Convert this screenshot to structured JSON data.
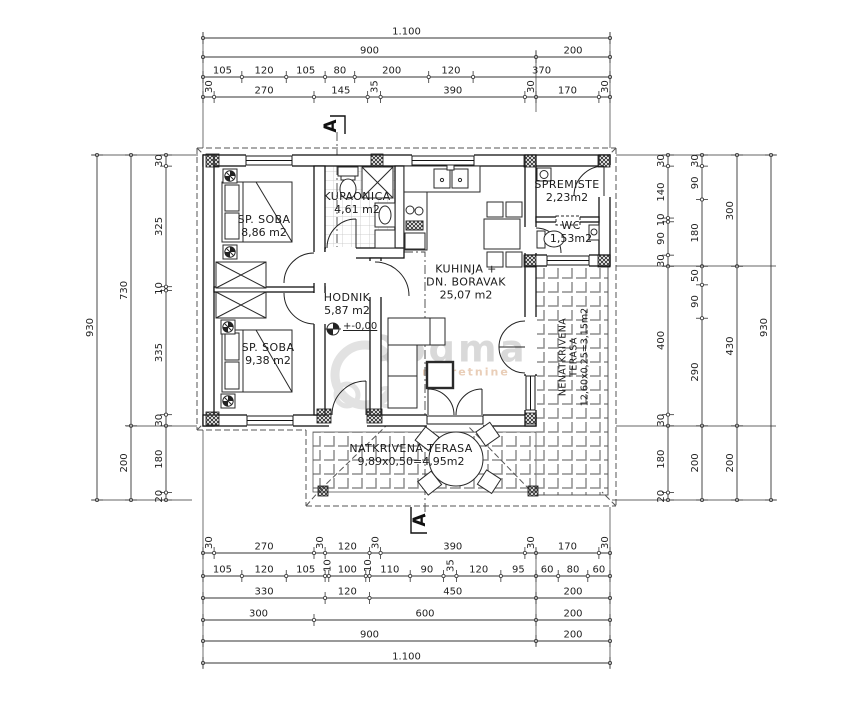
{
  "drawing": {
    "section_marker": "A",
    "elevation_label": "+-0,00",
    "watermark": {
      "text": "Dogma",
      "subtext": "nekretnine"
    }
  },
  "rooms": {
    "bedroom1": {
      "name": "SP. SOBA",
      "area": "8,86 m2"
    },
    "bathroom": {
      "name": "KUPAONICA",
      "area": "4,61 m2"
    },
    "storage": {
      "name": "SPREMISTE",
      "area": "2,23m2"
    },
    "wc": {
      "name": "WC",
      "area": "1,53m2"
    },
    "kitchen_living": {
      "name_line1": "KUHINJA +",
      "name_line2": "DN. BORAVAK",
      "area": "25,07 m2"
    },
    "hallway": {
      "name": "HODNIK",
      "area": "5,87 m2"
    },
    "bedroom2": {
      "name": "SP. SOBA",
      "area": "9,38 m2"
    },
    "covered_terrace": {
      "name": "NATKRIVENA TERASA",
      "area": "9,89x0,50=4,95m2"
    },
    "uncovered_terrace": {
      "name_line1": "NENATKRIVENA",
      "name_line2": "TERASA",
      "area": "12,60x0,25=3,15m2"
    }
  },
  "dimensions": {
    "top_rows": [
      [
        "1.100"
      ],
      [
        "900",
        "200"
      ],
      [
        "105",
        "120",
        "105",
        "80",
        "200",
        "120",
        "370"
      ],
      [
        "30",
        "270",
        "145",
        "35",
        "390",
        "30",
        "170",
        "30"
      ]
    ],
    "bottom_rows": [
      [
        "30",
        "270",
        "30",
        "120",
        "30",
        "390",
        "30",
        "170",
        "30"
      ],
      [
        "105",
        "120",
        "105",
        "10",
        "100",
        "10",
        "110",
        "90",
        "35",
        "120",
        "95",
        "60",
        "80",
        "60"
      ],
      [
        "330",
        "120",
        "450",
        "200"
      ],
      [
        "300",
        "600",
        "200"
      ],
      [
        "900",
        "200"
      ],
      [
        "1.100"
      ]
    ],
    "left_cols": [
      [
        "930"
      ],
      [
        "730",
        "200"
      ],
      [
        "30",
        "325",
        "10",
        "335",
        "30",
        "180",
        "20"
      ]
    ],
    "right_cols": [
      [
        "30",
        "140",
        "10",
        "90",
        "30",
        "400",
        "30",
        "180",
        "20"
      ],
      [
        "30",
        "90",
        "180",
        "50",
        "90",
        "290",
        "200"
      ],
      [
        "300",
        "430",
        "200"
      ],
      [
        "930"
      ]
    ]
  }
}
